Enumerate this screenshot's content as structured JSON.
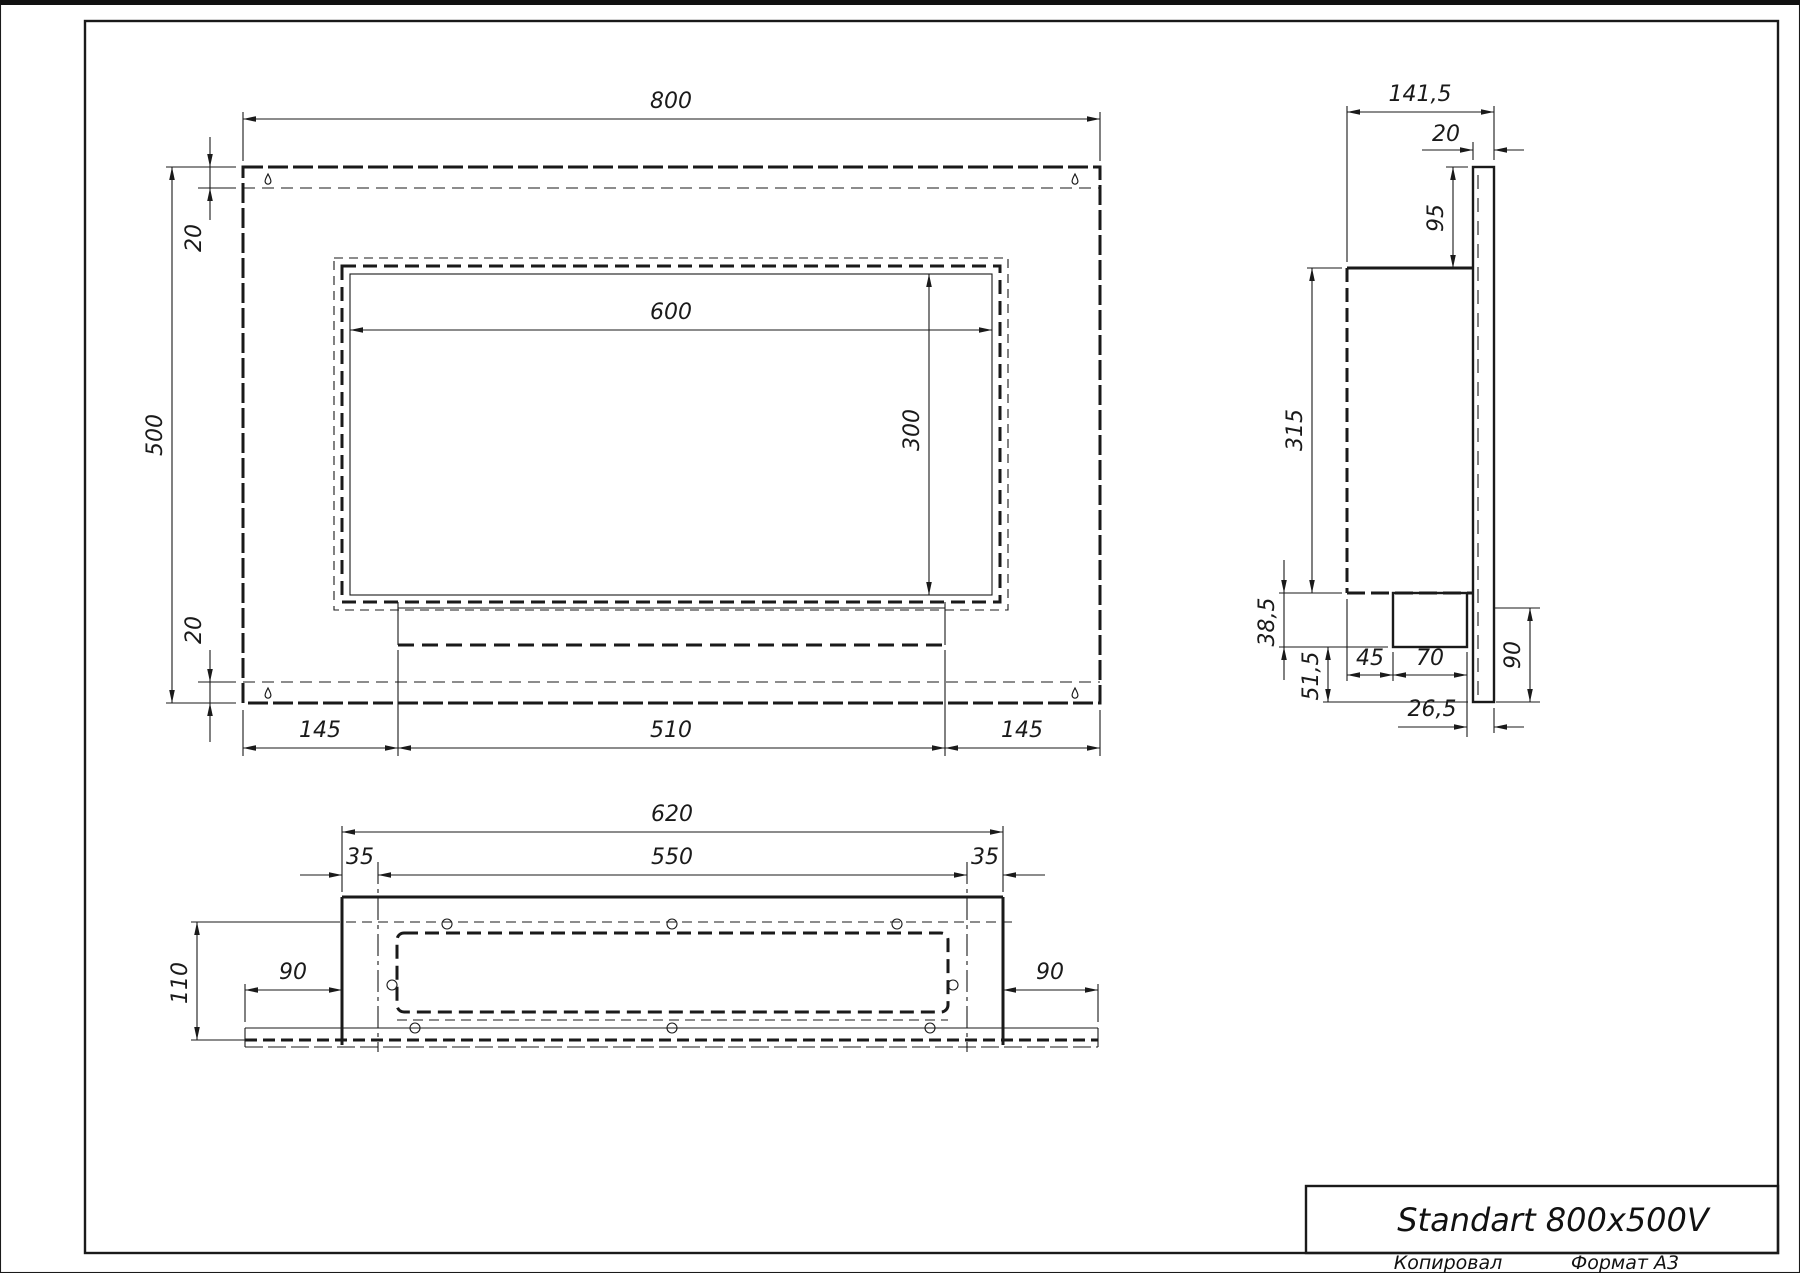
{
  "title_block": {
    "title": "Standart 800x500V",
    "copied_label": "Копировал",
    "format_label": "Формат А3"
  },
  "dims": {
    "front": {
      "width": "800",
      "height": "500",
      "top_offset": "20",
      "bottom_offset": "20",
      "window_width": "600",
      "window_height": "300",
      "bottom_left": "145",
      "bottom_center": "510",
      "bottom_right": "145"
    },
    "side": {
      "depth": "141,5",
      "panel_thickness": "20",
      "top_to_body": "95",
      "body_height": "315",
      "tray_depth": "38,5",
      "below_tray": "51,5",
      "tray_offset": "45",
      "tray_width": "70",
      "rear_gap": "26,5",
      "panel_below": "90"
    },
    "bottom": {
      "body_width": "620",
      "opening_width": "550",
      "margin_left": "35",
      "margin_right": "35",
      "depth": "110",
      "wing_left": "90",
      "wing_right": "90"
    }
  },
  "icons": {
    "mounting_slot": "keyhole-icon"
  }
}
